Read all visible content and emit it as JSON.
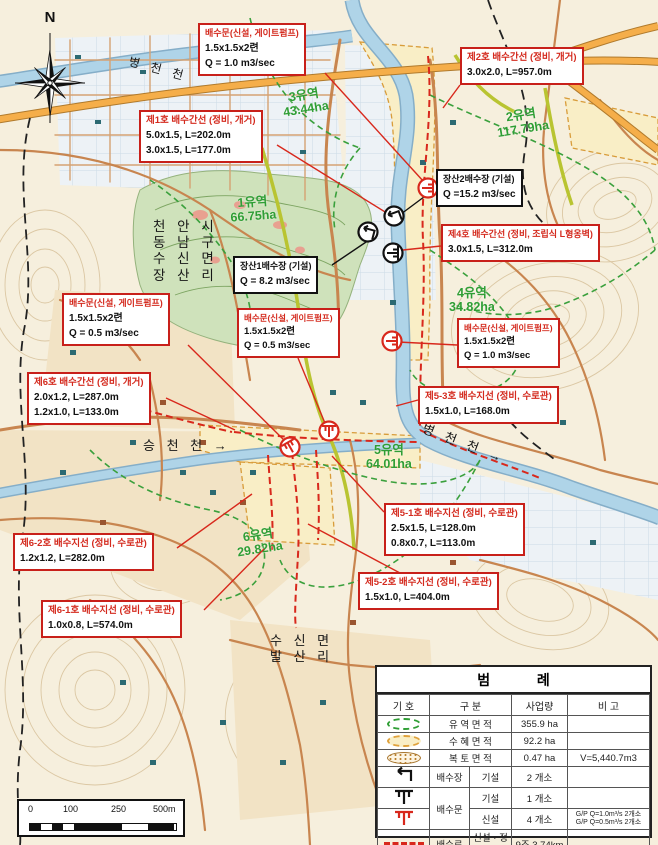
{
  "map": {
    "compass_label": "N",
    "place_labels": {
      "byeongcheon_top": "병 천 천",
      "admin_lines": [
        "천 안 시",
        "동 남 구",
        "수 신 면",
        "장 산 리"
      ],
      "seungcheon": "승 천 천 →",
      "byeongcheon_mid": "병 천 천 →",
      "balsan_lines": [
        "수 신 면",
        "발 산 리"
      ]
    },
    "watersheds": [
      {
        "name": "1유역",
        "area": "66.75ha"
      },
      {
        "name": "2유역",
        "area": "117.79ha"
      },
      {
        "name": "3유역",
        "area": "43.44ha"
      },
      {
        "name": "4유역",
        "area": "34.82ha"
      },
      {
        "name": "5유역",
        "area": "64.01ha"
      },
      {
        "name": "6유역",
        "area": "29.82ha"
      }
    ],
    "callouts": [
      {
        "type": "red",
        "title": "배수문(신설, 게이트펌프)",
        "lines": [
          "1.5x1.5x2련",
          "Q = 1.0 m3/sec"
        ]
      },
      {
        "type": "red",
        "title": "제2호 배수간선 (정비, 개거)",
        "lines": [
          "3.0x2.0, L=957.0m"
        ]
      },
      {
        "type": "red",
        "title": "제1호 배수간선 (정비, 개거)",
        "lines": [
          "5.0x1.5, L=202.0m",
          "3.0x1.5, L=177.0m"
        ]
      },
      {
        "type": "black",
        "title": "장산2배수장 (기설)",
        "lines": [
          "Q =15.2 m3/sec"
        ]
      },
      {
        "type": "red",
        "title": "제4호 배수간선 (정비, 조립식 L형옹벽)",
        "lines": [
          "3.0x1.5, L=312.0m"
        ]
      },
      {
        "type": "black",
        "title": "장산1배수장 (기설)",
        "lines": [
          "Q = 8.2 m3/sec"
        ]
      },
      {
        "type": "red",
        "title": "배수문(신설, 게이트펌프)",
        "lines": [
          "1.5x1.5x2련",
          "Q = 0.5 m3/sec"
        ]
      },
      {
        "type": "red",
        "title": "배수문(신설, 게이트펌프)",
        "lines": [
          "1.5x1.5x2련",
          "Q = 0.5 m3/sec"
        ]
      },
      {
        "type": "red",
        "title": "제6호 배수간선 (정비, 개거)",
        "lines": [
          "2.0x1.2, L=287.0m",
          "1.2x1.0, L=133.0m"
        ]
      },
      {
        "type": "red",
        "title": "배수문(신설, 게이트펌프)",
        "lines": [
          "1.5x1.5x2련",
          "Q = 1.0 m3/sec"
        ]
      },
      {
        "type": "red",
        "title": "제5-3호 배수지선 (정비, 수로관)",
        "lines": [
          "1.5x1.0, L=168.0m"
        ]
      },
      {
        "type": "red",
        "title": "제5-1호 배수지선 (정비, 수로관)",
        "lines": [
          "2.5x1.5, L=128.0m",
          "0.8x0.7, L=113.0m"
        ]
      },
      {
        "type": "red",
        "title": "제5-2호 배수지선 (정비, 수로관)",
        "lines": [
          "1.5x1.0, L=404.0m"
        ]
      },
      {
        "type": "red",
        "title": "제6-2호 배수지선 (정비, 수로관)",
        "lines": [
          "1.2x1.2, L=282.0m"
        ]
      },
      {
        "type": "red",
        "title": "제6-1호 배수지선 (정비, 수로관)",
        "lines": [
          "1.0x0.8, L=574.0m"
        ]
      }
    ]
  },
  "scale_bar": {
    "ticks": [
      "0",
      "100",
      "250",
      "500m"
    ]
  },
  "legend": {
    "title": "범            례",
    "headers": {
      "symbol": "기  호",
      "category": "구      분",
      "quantity": "사업량",
      "note": "비  고"
    },
    "rows": [
      {
        "category": "유 역 면 적",
        "qty": "355.9 ha",
        "note": ""
      },
      {
        "category": "수 혜 면 적",
        "qty": "92.2 ha",
        "note": ""
      },
      {
        "category": "복 토 면 적",
        "qty": "0.47 ha",
        "note": "V=5,440.7m3"
      },
      {
        "category": "배수장",
        "sub": "기설",
        "qty": "2  개소",
        "note": ""
      },
      {
        "category": "배수문",
        "sub": "기설",
        "qty": "1  개소",
        "note": ""
      },
      {
        "sub": "신설",
        "qty": "4  개소",
        "note_lines": [
          "G/P Q=1.0m³/s 2개소",
          "G/P Q=0.5m³/s 2개소"
        ]
      },
      {
        "category": "배수로",
        "sub": "신설 · 정비",
        "qty": "9조  3.74km",
        "note": ""
      }
    ]
  },
  "colors": {
    "callout_red": "#d42a1e",
    "watershed_green": "#2f9e35",
    "drain_red": "#d8281c",
    "river_blue": "#afd4e8",
    "highway_orange": "#f5ae4a"
  }
}
